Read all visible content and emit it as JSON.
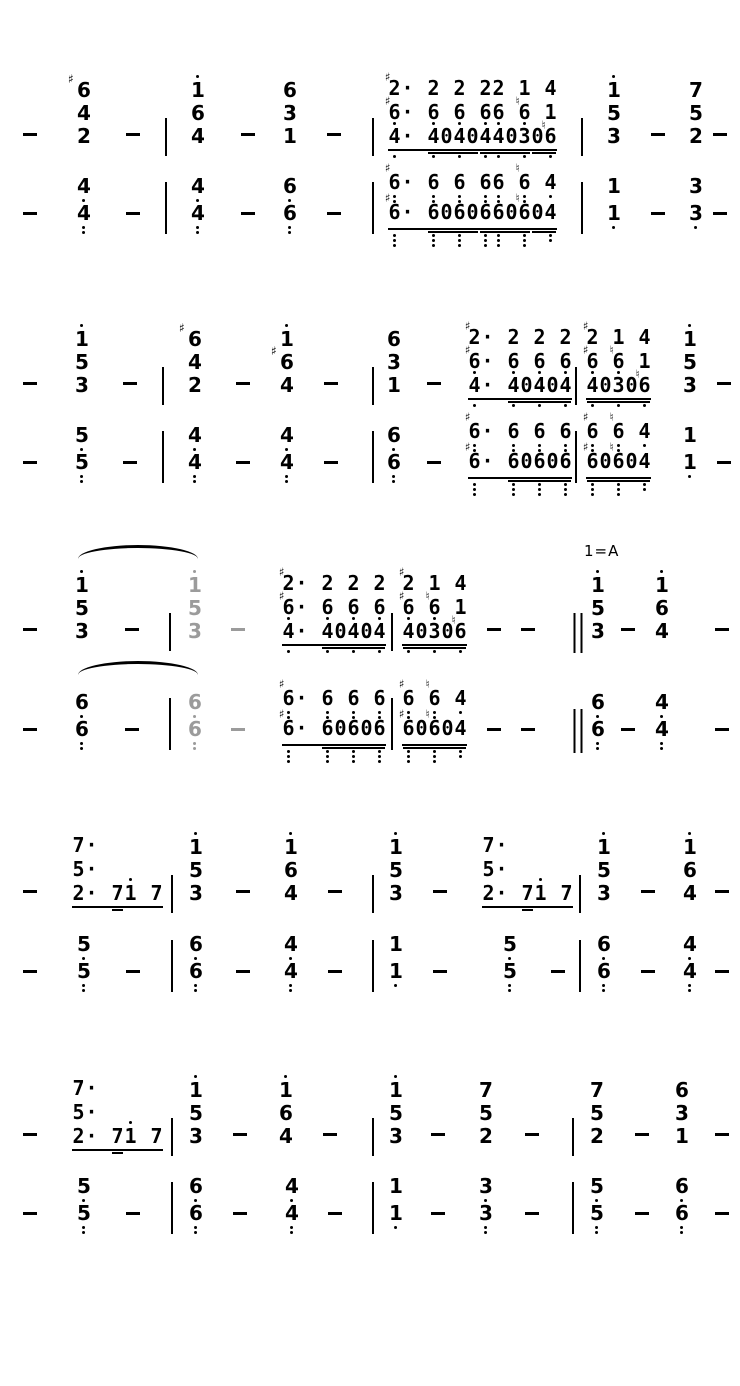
{
  "page": {
    "width": 740,
    "height": 1386,
    "ink": "#000000",
    "muted": "#9b9b9b"
  },
  "overlays": {
    "key_label": {
      "text": "1=A",
      "x": 584,
      "y": 542
    },
    "ties": [
      {
        "x": 78,
        "y": 545,
        "w": 120,
        "h": 14
      },
      {
        "x": 78,
        "y": 661,
        "w": 120,
        "h": 14
      }
    ]
  },
  "beams": {
    "tf": {
      "lines": [
        [
          "#2",
          "·",
          "_",
          "2",
          "_",
          "2",
          "_",
          "2",
          "2",
          "_",
          "1",
          "_",
          "4"
        ],
        [
          "#6,",
          "·",
          "_",
          "6,",
          "_",
          "6,",
          "_",
          "6,",
          "6,",
          "_",
          "n6,",
          "_",
          "1"
        ],
        [
          "4,",
          "·",
          "_",
          "4,",
          "0",
          "4,",
          "0",
          "4,",
          "4,",
          "0",
          "3,",
          "0",
          "n6,"
        ]
      ],
      "b2": [
        [
          3,
          6
        ],
        [
          7,
          10
        ],
        [
          11,
          12
        ]
      ]
    },
    "bf": {
      "lines": [
        [
          "#6,,",
          "·",
          "_",
          "6,,",
          "_",
          "6,,",
          "_",
          "6,,",
          "6,,",
          "_",
          "n6,,",
          "_",
          "4,"
        ],
        [
          "#6,,,",
          "·",
          "_",
          "6,,,",
          "0",
          "6,,,",
          "0",
          "6,,,",
          "6,,,",
          "0",
          "n6,,,",
          "0",
          "4,,"
        ]
      ],
      "b2": [
        [
          3,
          6
        ],
        [
          7,
          10
        ],
        [
          11,
          12
        ]
      ]
    },
    "ta": {
      "lines": [
        [
          "#2",
          "·",
          "_",
          "2",
          "_",
          "2",
          "_",
          "2"
        ],
        [
          "#6,",
          "·",
          "_",
          "6,",
          "_",
          "6,",
          "_",
          "6,"
        ],
        [
          "4,",
          "·",
          "_",
          "4,",
          "0",
          "4,",
          "0",
          "4,"
        ]
      ],
      "b2": [
        [
          3,
          7
        ]
      ]
    },
    "tb": {
      "lines": [
        [
          "#2",
          "_",
          "1",
          "_",
          "4"
        ],
        [
          "#6,",
          "_",
          "n6,",
          "_",
          "1"
        ],
        [
          "4,",
          "0",
          "3,",
          "0",
          "n6,"
        ]
      ],
      "b2": [
        [
          0,
          4
        ]
      ]
    },
    "ba": {
      "lines": [
        [
          "#6,,",
          "·",
          "_",
          "6,,",
          "_",
          "6,,",
          "_",
          "6,,"
        ],
        [
          "#6,,,",
          "·",
          "_",
          "6,,,",
          "0",
          "6,,,",
          "0",
          "6,,,"
        ]
      ],
      "b2": [
        [
          3,
          7
        ]
      ]
    },
    "bb": {
      "lines": [
        [
          "#6,,",
          "_",
          "n6,,",
          "_",
          "4,"
        ],
        [
          "#6,,,",
          "0",
          "n6,,,",
          "0",
          "4,,"
        ]
      ],
      "b2": [
        [
          0,
          4
        ]
      ]
    },
    "m717": {
      "lines": [
        [
          "7",
          "·"
        ],
        [
          "5",
          "·"
        ],
        [
          "2",
          "·",
          "_",
          "7",
          "1'",
          "_",
          "7"
        ]
      ],
      "b2": [
        [
          3,
          3
        ]
      ]
    }
  },
  "staves": [
    {
      "name": "system-1-upper-stave",
      "baseline": 143,
      "bass": false,
      "cells": [
        {
          "k": "dash",
          "x": 30
        },
        {
          "k": "chord",
          "x": 84,
          "notes": [
            "#6",
            "4",
            "2"
          ]
        },
        {
          "k": "dash",
          "x": 133
        },
        {
          "k": "bar",
          "x": 166
        },
        {
          "k": "chord",
          "x": 198,
          "notes": [
            "1'",
            "6",
            "4"
          ]
        },
        {
          "k": "dash",
          "x": 248
        },
        {
          "k": "chord",
          "x": 290,
          "notes": [
            "6",
            "3",
            "1"
          ]
        },
        {
          "k": "dash",
          "x": 334
        },
        {
          "k": "bar",
          "x": 373
        },
        {
          "k": "beam",
          "x": 388,
          "ref": "tf"
        },
        {
          "k": "bar",
          "x": 582
        },
        {
          "k": "chord",
          "x": 614,
          "notes": [
            "1'",
            "5",
            "3"
          ]
        },
        {
          "k": "dash",
          "x": 658
        },
        {
          "k": "chord",
          "x": 696,
          "notes": [
            "7",
            "5",
            "2"
          ]
        },
        {
          "k": "dash",
          "x": 720
        }
      ]
    },
    {
      "name": "system-1-lower-stave",
      "baseline": 222,
      "bass": true,
      "cells": [
        {
          "k": "dash",
          "x": 30
        },
        {
          "k": "chord",
          "x": 84,
          "notes": [
            "4,",
            "4,,"
          ]
        },
        {
          "k": "dash",
          "x": 133
        },
        {
          "k": "bar",
          "x": 166
        },
        {
          "k": "chord",
          "x": 198,
          "notes": [
            "4,",
            "4,,"
          ]
        },
        {
          "k": "dash",
          "x": 248
        },
        {
          "k": "chord",
          "x": 290,
          "notes": [
            "6,",
            "6,,"
          ]
        },
        {
          "k": "dash",
          "x": 334
        },
        {
          "k": "bar",
          "x": 373
        },
        {
          "k": "beam",
          "x": 388,
          "ref": "bf"
        },
        {
          "k": "bar",
          "x": 582
        },
        {
          "k": "chord",
          "x": 614,
          "notes": [
            "1",
            "1,"
          ]
        },
        {
          "k": "dash",
          "x": 658
        },
        {
          "k": "chord",
          "x": 696,
          "notes": [
            "3",
            "3,"
          ]
        },
        {
          "k": "dash",
          "x": 720
        }
      ]
    },
    {
      "name": "system-2-upper-stave",
      "baseline": 392,
      "bass": false,
      "cells": [
        {
          "k": "dash",
          "x": 30
        },
        {
          "k": "chord",
          "x": 82,
          "notes": [
            "1'",
            "5",
            "3"
          ]
        },
        {
          "k": "dash",
          "x": 130
        },
        {
          "k": "bar",
          "x": 163
        },
        {
          "k": "chord",
          "x": 195,
          "notes": [
            "#6",
            "4",
            "2"
          ]
        },
        {
          "k": "dash",
          "x": 243
        },
        {
          "k": "chord",
          "x": 287,
          "notes": [
            "1'",
            "#6",
            "4"
          ]
        },
        {
          "k": "dash",
          "x": 331
        },
        {
          "k": "bar",
          "x": 373
        },
        {
          "k": "chord",
          "x": 394,
          "notes": [
            "6",
            "3",
            "1"
          ]
        },
        {
          "k": "dash",
          "x": 434
        },
        {
          "k": "beam",
          "x": 468,
          "ref": "ta"
        },
        {
          "k": "bar",
          "x": 576
        },
        {
          "k": "beam",
          "x": 586,
          "ref": "tb"
        },
        {
          "k": "chord",
          "x": 690,
          "notes": [
            "1'",
            "5",
            "3"
          ]
        },
        {
          "k": "dash",
          "x": 724
        }
      ]
    },
    {
      "name": "system-2-lower-stave",
      "baseline": 471,
      "bass": true,
      "cells": [
        {
          "k": "dash",
          "x": 30
        },
        {
          "k": "chord",
          "x": 82,
          "notes": [
            "5,",
            "5,,"
          ]
        },
        {
          "k": "dash",
          "x": 130
        },
        {
          "k": "bar",
          "x": 163
        },
        {
          "k": "chord",
          "x": 195,
          "notes": [
            "4,",
            "4,,"
          ]
        },
        {
          "k": "dash",
          "x": 243
        },
        {
          "k": "chord",
          "x": 287,
          "notes": [
            "4,",
            "4,,"
          ]
        },
        {
          "k": "dash",
          "x": 331
        },
        {
          "k": "bar",
          "x": 373
        },
        {
          "k": "chord",
          "x": 394,
          "notes": [
            "6,",
            "6,,"
          ]
        },
        {
          "k": "dash",
          "x": 434
        },
        {
          "k": "beam",
          "x": 468,
          "ref": "ba"
        },
        {
          "k": "bar",
          "x": 576
        },
        {
          "k": "beam",
          "x": 586,
          "ref": "bb"
        },
        {
          "k": "chord",
          "x": 690,
          "notes": [
            "1",
            "1,"
          ]
        },
        {
          "k": "dash",
          "x": 724
        }
      ]
    },
    {
      "name": "system-3-upper-stave",
      "baseline": 638,
      "bass": false,
      "cells": [
        {
          "k": "dash",
          "x": 30
        },
        {
          "k": "chord",
          "x": 82,
          "notes": [
            "1'",
            "5",
            "3"
          ]
        },
        {
          "k": "dash",
          "x": 132
        },
        {
          "k": "bar",
          "x": 170
        },
        {
          "k": "chord",
          "x": 195,
          "notes": [
            "1'",
            "5",
            "3"
          ],
          "gray": true
        },
        {
          "k": "dash",
          "x": 238,
          "gray": true
        },
        {
          "k": "beam",
          "x": 282,
          "ref": "ta"
        },
        {
          "k": "bar",
          "x": 392
        },
        {
          "k": "beam",
          "x": 402,
          "ref": "tb"
        },
        {
          "k": "dash",
          "x": 494
        },
        {
          "k": "dash",
          "x": 528
        },
        {
          "k": "dbar",
          "x": 578
        },
        {
          "k": "chord",
          "x": 598,
          "notes": [
            "1'",
            "5",
            "3"
          ]
        },
        {
          "k": "dash",
          "x": 628
        },
        {
          "k": "chord",
          "x": 662,
          "notes": [
            "1'",
            "6",
            "4"
          ]
        },
        {
          "k": "dash",
          "x": 722
        }
      ]
    },
    {
      "name": "system-3-lower-stave",
      "baseline": 738,
      "bass": true,
      "cells": [
        {
          "k": "dash",
          "x": 30
        },
        {
          "k": "chord",
          "x": 82,
          "notes": [
            "6,",
            "6,,"
          ]
        },
        {
          "k": "dash",
          "x": 132
        },
        {
          "k": "bar",
          "x": 170
        },
        {
          "k": "chord",
          "x": 195,
          "notes": [
            "6,",
            "6,,"
          ],
          "gray": true
        },
        {
          "k": "dash",
          "x": 238,
          "gray": true
        },
        {
          "k": "beam",
          "x": 282,
          "ref": "ba"
        },
        {
          "k": "bar",
          "x": 392
        },
        {
          "k": "beam",
          "x": 402,
          "ref": "bb"
        },
        {
          "k": "dash",
          "x": 494
        },
        {
          "k": "dash",
          "x": 528
        },
        {
          "k": "dbar",
          "x": 578
        },
        {
          "k": "chord",
          "x": 598,
          "notes": [
            "6,",
            "6,,"
          ]
        },
        {
          "k": "dash",
          "x": 628
        },
        {
          "k": "chord",
          "x": 662,
          "notes": [
            "4,",
            "4,,"
          ]
        },
        {
          "k": "dash",
          "x": 722
        }
      ]
    },
    {
      "name": "system-4-upper-stave",
      "baseline": 900,
      "bass": false,
      "cells": [
        {
          "k": "dash",
          "x": 30
        },
        {
          "k": "beam",
          "x": 72,
          "ref": "m717"
        },
        {
          "k": "bar",
          "x": 172
        },
        {
          "k": "chord",
          "x": 196,
          "notes": [
            "1'",
            "5",
            "3"
          ]
        },
        {
          "k": "dash",
          "x": 243
        },
        {
          "k": "chord",
          "x": 291,
          "notes": [
            "1'",
            "6",
            "4"
          ]
        },
        {
          "k": "dash",
          "x": 335
        },
        {
          "k": "bar",
          "x": 373
        },
        {
          "k": "chord",
          "x": 396,
          "notes": [
            "1'",
            "5",
            "3"
          ]
        },
        {
          "k": "dash",
          "x": 440
        },
        {
          "k": "beam",
          "x": 482,
          "ref": "m717"
        },
        {
          "k": "bar",
          "x": 580
        },
        {
          "k": "chord",
          "x": 604,
          "notes": [
            "1'",
            "5",
            "3"
          ]
        },
        {
          "k": "dash",
          "x": 648
        },
        {
          "k": "chord",
          "x": 690,
          "notes": [
            "1'",
            "6",
            "4"
          ]
        },
        {
          "k": "dash",
          "x": 722
        }
      ]
    },
    {
      "name": "system-4-lower-stave",
      "baseline": 980,
      "bass": true,
      "cells": [
        {
          "k": "dash",
          "x": 30
        },
        {
          "k": "chord",
          "x": 84,
          "notes": [
            "5,",
            "5,,"
          ]
        },
        {
          "k": "dash",
          "x": 133
        },
        {
          "k": "bar",
          "x": 172
        },
        {
          "k": "chord",
          "x": 196,
          "notes": [
            "6,",
            "6,,"
          ]
        },
        {
          "k": "dash",
          "x": 243
        },
        {
          "k": "chord",
          "x": 291,
          "notes": [
            "4,",
            "4,,"
          ]
        },
        {
          "k": "dash",
          "x": 335
        },
        {
          "k": "bar",
          "x": 373
        },
        {
          "k": "chord",
          "x": 396,
          "notes": [
            "1",
            "1,"
          ]
        },
        {
          "k": "dash",
          "x": 440
        },
        {
          "k": "chord",
          "x": 510,
          "notes": [
            "5,",
            "5,,"
          ]
        },
        {
          "k": "dash",
          "x": 558
        },
        {
          "k": "bar",
          "x": 580
        },
        {
          "k": "chord",
          "x": 604,
          "notes": [
            "6,",
            "6,,"
          ]
        },
        {
          "k": "dash",
          "x": 648
        },
        {
          "k": "chord",
          "x": 690,
          "notes": [
            "4,",
            "4,,"
          ]
        },
        {
          "k": "dash",
          "x": 722
        }
      ]
    },
    {
      "name": "system-5-upper-stave",
      "baseline": 1143,
      "bass": false,
      "cells": [
        {
          "k": "dash",
          "x": 30
        },
        {
          "k": "beam",
          "x": 72,
          "ref": "m717"
        },
        {
          "k": "bar",
          "x": 172
        },
        {
          "k": "chord",
          "x": 196,
          "notes": [
            "1'",
            "5",
            "3"
          ]
        },
        {
          "k": "dash",
          "x": 240
        },
        {
          "k": "chord",
          "x": 286,
          "notes": [
            "1'",
            "6",
            "4"
          ]
        },
        {
          "k": "dash",
          "x": 330
        },
        {
          "k": "bar",
          "x": 373
        },
        {
          "k": "chord",
          "x": 396,
          "notes": [
            "1'",
            "5",
            "3"
          ]
        },
        {
          "k": "dash",
          "x": 438
        },
        {
          "k": "chord",
          "x": 486,
          "notes": [
            "7",
            "5",
            "2"
          ]
        },
        {
          "k": "dash",
          "x": 532
        },
        {
          "k": "bar",
          "x": 573
        },
        {
          "k": "chord",
          "x": 597,
          "notes": [
            "7",
            "5",
            "2"
          ]
        },
        {
          "k": "dash",
          "x": 642
        },
        {
          "k": "chord",
          "x": 682,
          "notes": [
            "6",
            "3",
            "1"
          ]
        },
        {
          "k": "dash",
          "x": 722
        }
      ]
    },
    {
      "name": "system-5-lower-stave",
      "baseline": 1222,
      "bass": true,
      "cells": [
        {
          "k": "dash",
          "x": 30
        },
        {
          "k": "chord",
          "x": 84,
          "notes": [
            "5,",
            "5,,"
          ]
        },
        {
          "k": "dash",
          "x": 133
        },
        {
          "k": "bar",
          "x": 172
        },
        {
          "k": "chord",
          "x": 196,
          "notes": [
            "6,",
            "6,,"
          ]
        },
        {
          "k": "dash",
          "x": 240
        },
        {
          "k": "chord",
          "x": 292,
          "notes": [
            "4,",
            "4,,"
          ]
        },
        {
          "k": "dash",
          "x": 335
        },
        {
          "k": "bar",
          "x": 373
        },
        {
          "k": "chord",
          "x": 396,
          "notes": [
            "1",
            "1,"
          ]
        },
        {
          "k": "dash",
          "x": 438
        },
        {
          "k": "chord",
          "x": 486,
          "notes": [
            "3,",
            "3,,"
          ]
        },
        {
          "k": "dash",
          "x": 532
        },
        {
          "k": "bar",
          "x": 573
        },
        {
          "k": "chord",
          "x": 597,
          "notes": [
            "5,",
            "5,,"
          ]
        },
        {
          "k": "dash",
          "x": 642
        },
        {
          "k": "chord",
          "x": 682,
          "notes": [
            "6,",
            "6,,"
          ]
        },
        {
          "k": "dash",
          "x": 722
        }
      ]
    }
  ]
}
